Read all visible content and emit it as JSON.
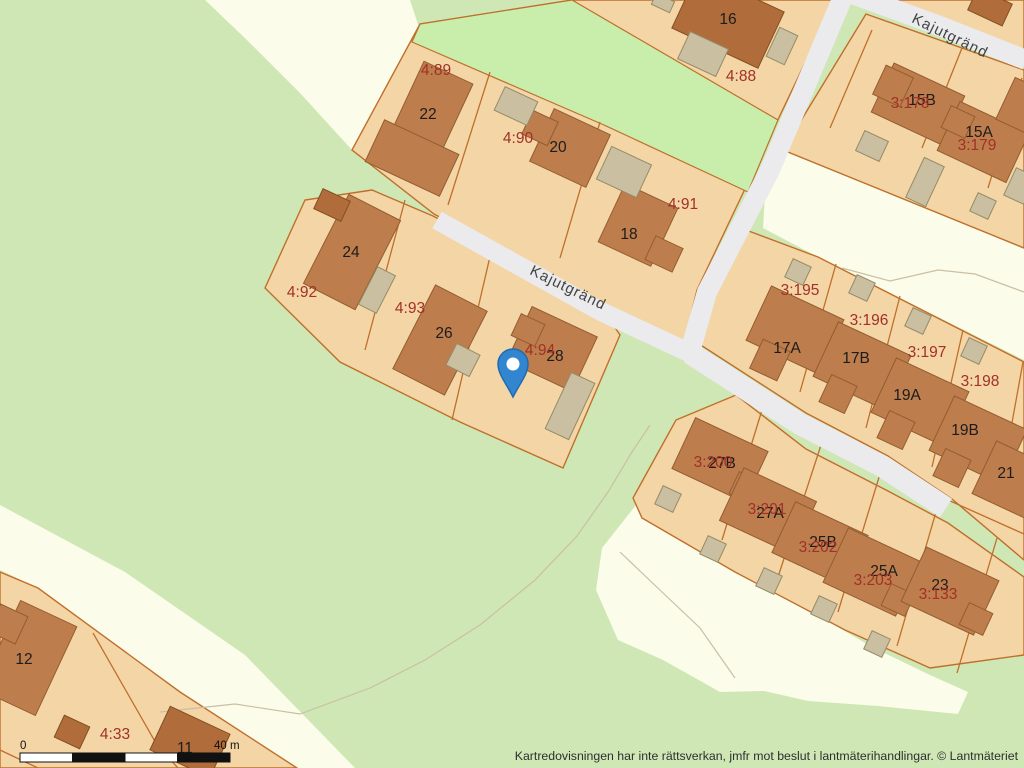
{
  "map": {
    "streets": [
      "Kajutgränd",
      "Kajutgränd"
    ],
    "house_numbers": [
      "16",
      "22",
      "20",
      "18",
      "24",
      "26",
      "28",
      "15B",
      "15A",
      "17A",
      "17B",
      "19A",
      "19B",
      "21",
      "27B",
      "27A",
      "25B",
      "25A",
      "23",
      "12",
      "11"
    ],
    "parcel_numbers": [
      "4:89",
      "4:88",
      "4:90",
      "4:91",
      "4:92",
      "4:93",
      "4:94",
      "3:178",
      "3:179",
      "3:195",
      "3:196",
      "3:197",
      "3:198",
      "3:200",
      "3:201",
      "3:202",
      "3:203",
      "3:133",
      "4:33"
    ],
    "marker": "location-pin",
    "colors": {
      "background_green": "#cfe7b5",
      "field_green": "#c9eeab",
      "open_cream": "#fbfce9",
      "parcel_tan": "#f4d5a6",
      "parcel_border": "#bf6f2b",
      "building": "#bd7d4c",
      "building_dark": "#b06c3a",
      "outbuilding": "#cabfa0",
      "road": "#ebebee",
      "parcel_label": "#a23128",
      "house_label": "#1c1c1c",
      "marker_blue": "#3286cf"
    }
  },
  "scale_bar": {
    "start": "0",
    "end": "40 m"
  },
  "attribution": "Kartredovisningen har inte rättsverkan, jmfr mot beslut i lantmäterihandlingar. © Lantmäteriet"
}
